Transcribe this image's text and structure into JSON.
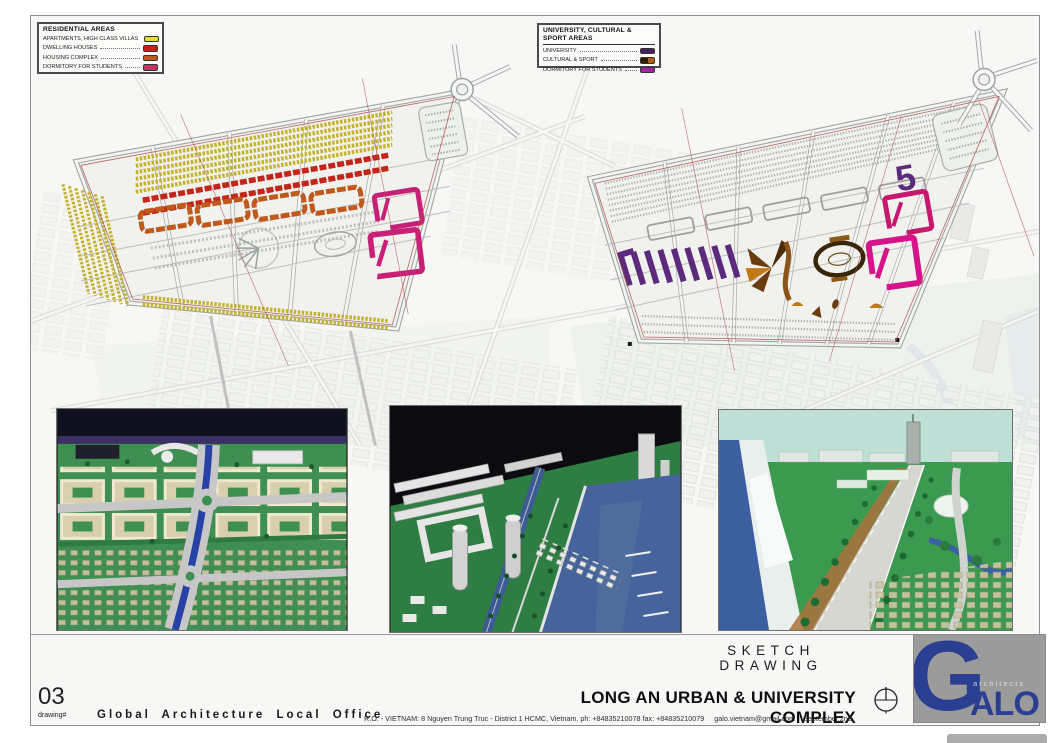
{
  "sheet": {
    "background": "#f7f7f5",
    "border_color": "#8f8f8f"
  },
  "legends": [
    {
      "title": "RESIDENTIAL AREAS",
      "items": [
        {
          "label": "APARTMENTS, HIGH CLASS VILLAS",
          "color": "#e2da3c"
        },
        {
          "label": "DWELLING HOUSES",
          "color": "#c1241c"
        },
        {
          "label": "HOUSING COMPLEX",
          "color": "#bf5a1e"
        },
        {
          "label": "DORMITORY FOR STUDENTS",
          "color": "#ce2e66"
        }
      ]
    },
    {
      "title": "UNIVERSITY, CULTURAL & SPORT AREAS",
      "items": [
        {
          "label": "UNIVERSITY",
          "color": "#45215c"
        },
        {
          "label": "CULTURAL & SPORT",
          "color": "#2f1d08",
          "color2": "#b05f14"
        },
        {
          "label": "DORMITORY FOR STUDENTS",
          "color": "#a81fa8"
        }
      ]
    }
  ],
  "title_block": {
    "sketch_label": "SKETCH DRAWING",
    "project_title": "LONG AN URBAN & UNIVERSITY COMPLEX",
    "drawing_number": "03",
    "drawing_number_label": "drawing#",
    "firm_name": "Global Architecture Local Office",
    "address": "R.O. - VIETNAM: 8 Nguyen Trung Truc - District 1   HCMC, Vietnam. ph: +84835210078   fax: +84835210079",
    "email": "galo.vietnam@gmail.com",
    "date": "September,2nd"
  },
  "logo": {
    "initial": "G",
    "rest": "ALO",
    "tagline": "architects",
    "blue": "#2a3f92",
    "background": "#9b9b9b"
  },
  "plan_colors": {
    "apartments_yellow": "#c3b32a",
    "dwelling_red": "#c3251a",
    "housing_orange": "#c0591c",
    "dormitory_pink": "#c92077",
    "university_purple": "#5b2a7d",
    "cultural_brown": "#6b3c0d",
    "dormitory_magenta": "#d6138a",
    "boundary_red": "#b24a4a",
    "road_gray": "#a8a8a8"
  }
}
